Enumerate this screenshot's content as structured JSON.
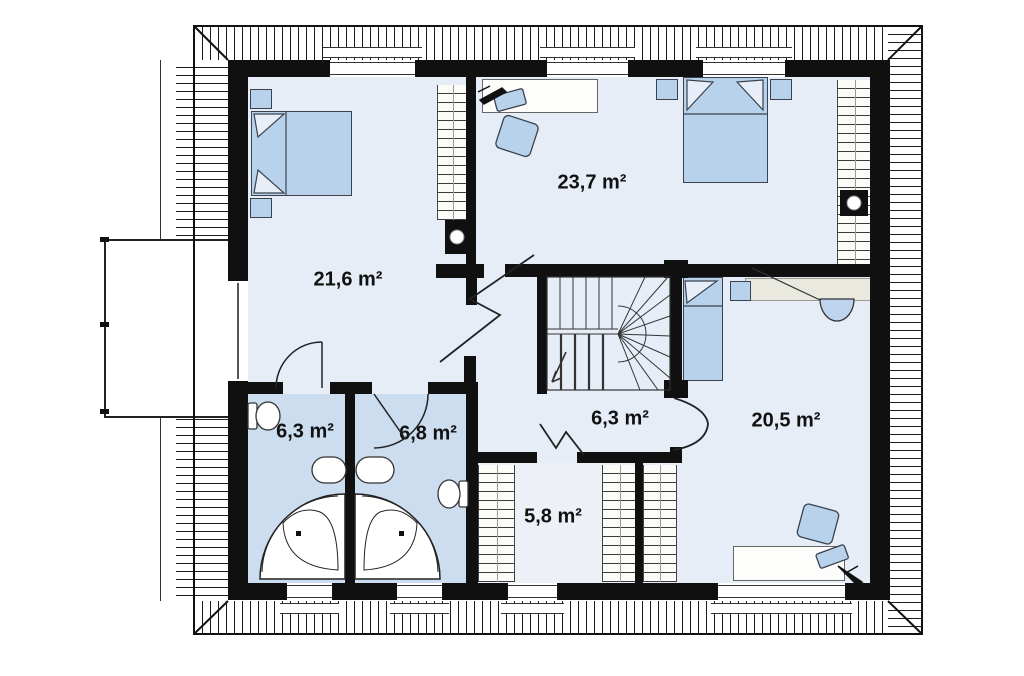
{
  "type": "floor-plan-drawing",
  "rooms": [
    {
      "name": "bedroom-top-left",
      "area_label": "21,6 m²"
    },
    {
      "name": "bedroom-top-right",
      "area_label": "23,7 m²"
    },
    {
      "name": "bathroom-left",
      "area_label": "6,3 m²"
    },
    {
      "name": "bathroom-right",
      "area_label": "6,8 m²"
    },
    {
      "name": "hall-landing",
      "area_label": "6,3 m²"
    },
    {
      "name": "wardrobe-room",
      "area_label": "5,8 m²"
    },
    {
      "name": "bedroom-bottom-right",
      "area_label": "20,5 m²"
    }
  ],
  "colors": {
    "wall": "#101010",
    "floor": "#e7edf7",
    "bathroom": "#cdddf0",
    "furniture": "#b9d2ec",
    "label_text": "#111111"
  }
}
